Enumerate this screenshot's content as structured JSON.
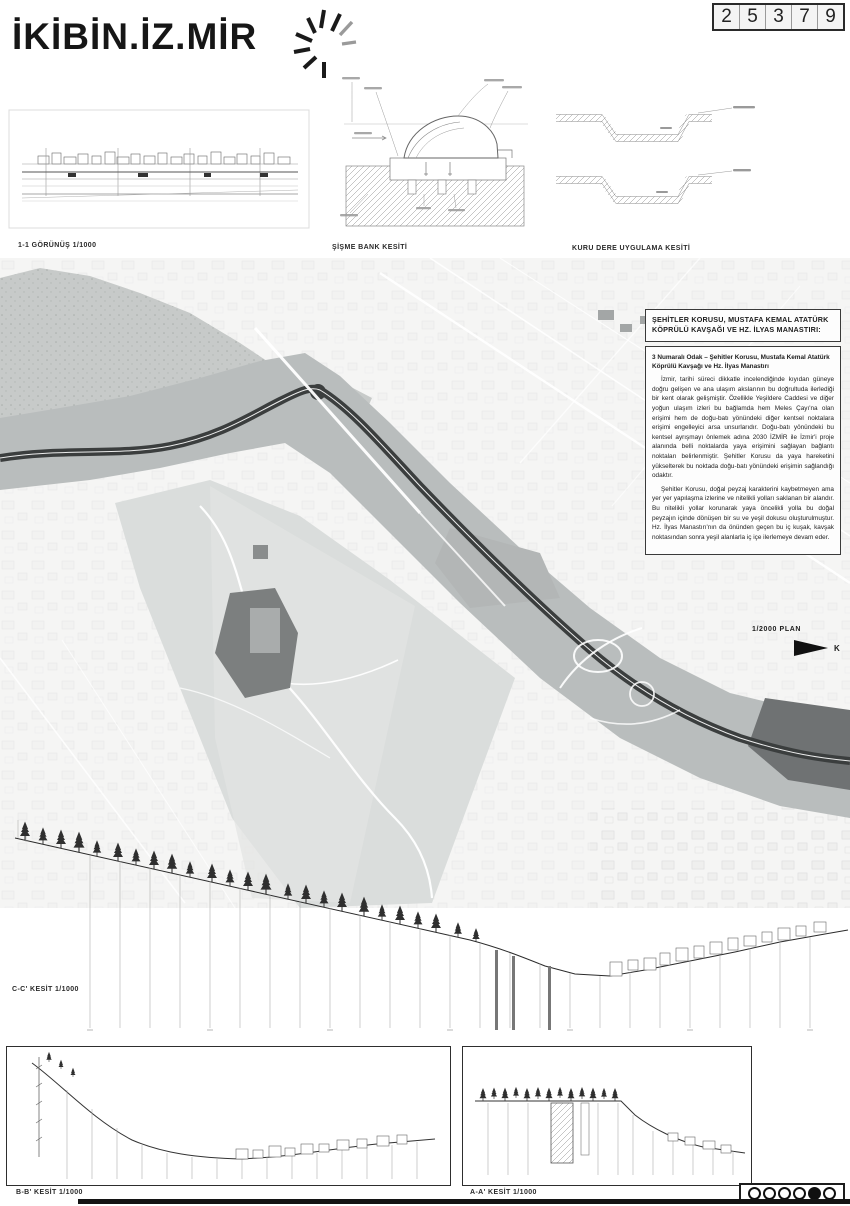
{
  "header": {
    "logo": "İKİBİN.İZ.MİR",
    "competition_number": "25379"
  },
  "captions": {
    "elevation": "1-1 GÖRÜNÜŞ 1/1000",
    "bench": "ŞİŞME BANK KESİTİ",
    "creek": "KURU DERE UYGULAMA KESİTİ",
    "plan_scale": "1/2000 PLAN",
    "north": "K",
    "section_c": "C-C' KESİT 1/1000",
    "section_b": "B-B' KESİT 1/1000",
    "section_a": "A-A' KESİT 1/1000"
  },
  "text_panel": {
    "title": "ŞEHİTLER KORUSU, MUSTAFA KEMAL ATATÜRK KÖPRÜLÜ KAVŞAĞI VE HZ. İLYAS MANASTIRI:",
    "lead": "3 Numaralı Odak – Şehitler Korusu, Mustafa Kemal Atatürk Köprülü Kavşağı ve Hz. İlyas Manastırı",
    "body1": "İzmir, tarihi süreci dikkatle incelendiğinde kıyıdan güneye doğru gelişen ve ana ulaşım akslarının bu doğrultuda ilerlediği bir kent olarak gelişmiştir. Özellikle Yeşildere Caddesi ve diğer yoğun ulaşım izleri bu bağlamda hem Meles Çayı'na olan erişimi hem de doğu-batı yönündeki diğer kentsel noktalara erişimi engelleyici arsa unsurlarıdır. Doğu-batı yönündeki bu kentsel ayrışmayı önlemek adına 2030 İZMİR ile İzmir'i proje alanında belli noktalarda yaya erişimini sağlayan bağlantı noktaları belirlenmiştir. Şehitler Korusu da yaya hareketini yükselterek bu noktada doğu-batı yönündeki erişimin sağlandığı odaktır.",
    "body2": "Şehitler Korusu, doğal peyzaj karakterini kaybetmeyen ama yer yer yapılaşma izlerine ve nitelikli yolları saklanan bir alandır. Bu nitelikli yollar korunarak yaya öncelikli yolla bu doğal peyzajın içinde dönüşen bir su ve yeşil dokusu oluşturulmuştur. Hz. İlyas Manastırı'nın da önünden geçen bu iç kuşak, kavşak noktasından sonra yeşil alanlarla iç içe ilerlemeye devam eder."
  },
  "pagination": {
    "dots": [
      false,
      false,
      false,
      false,
      true,
      false
    ]
  },
  "colors": {
    "ink": "#1d1d1d",
    "map_corridor": "#b9bdbd",
    "map_park": "#dadddc",
    "map_dark_poly": "#6f7273",
    "map_river": "#3b3e3e"
  }
}
